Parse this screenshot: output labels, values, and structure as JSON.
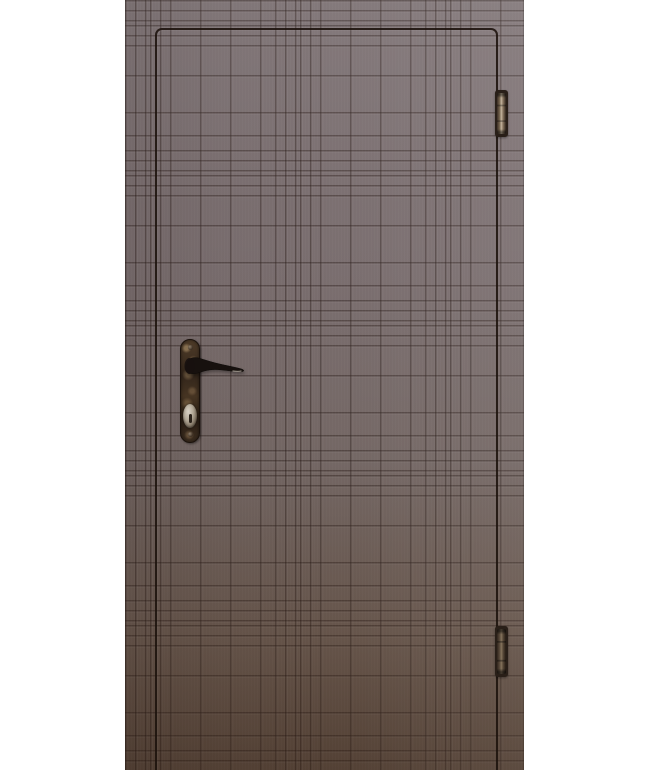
{
  "scene": {
    "type": "product-photo",
    "subject": "entrance door leaf, brown laminated panel milled with a plaid (tartan) groove pattern, hinged on the right",
    "background_color": "#ffffff",
    "objects": [
      "door-leaf",
      "plaid-groove-texture",
      "recessed-panel-outline",
      "antique-bronze-lever-handle",
      "handle-backplate",
      "lock-cylinder-keyhole",
      "top-hinge",
      "bottom-hinge"
    ]
  },
  "css_vars": {
    "bg": "#ffffff",
    "door-left": "125px",
    "door-width": "399px",
    "door-height": "770px",
    "door-top-color": "#7d7274",
    "door-mid-color": "#7b6f70",
    "door-low-color": "#6c5c53",
    "door-bottom-color": "#5e4d42",
    "groove-dark": "rgba(38,24,20,0.40)",
    "groove-light": "rgba(255,255,255,0.06)",
    "panel-line": "rgba(28,18,12,0.88)",
    "panel-left": "30px",
    "panel-top": "28px",
    "panel-width": "339px",
    "hinge-left": "370px",
    "hinge-frame": "#291f18",
    "hinge-metal-bright": "#c3b49d",
    "hinge-metal-mid": "#76654f",
    "plate-left": "55px",
    "plate-top": "339px",
    "plate-width": "20px",
    "plate-height": "104px",
    "bronze-dark": "#33261b",
    "bronze-mid": "#4e3b28",
    "bronze-light": "#8d7657",
    "lever-color": "#17110e",
    "cylinder-bright": "#d9d2c6",
    "cylinder-dark": "#453a2e"
  }
}
